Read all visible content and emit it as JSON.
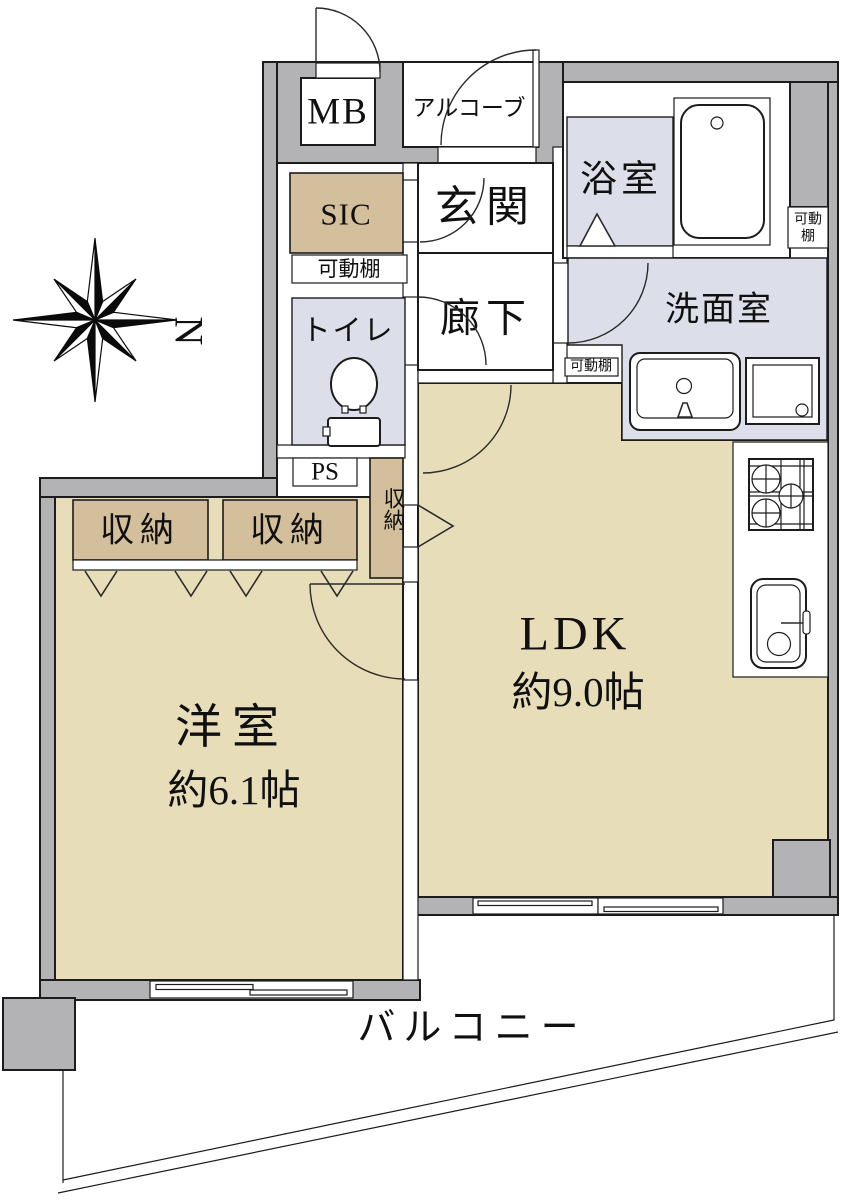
{
  "labels": {
    "mb": "MB",
    "alcove": "アルコーブ",
    "sic": "SIC",
    "entrance": "玄関",
    "hallway": "廊下",
    "bathroom": "浴室",
    "washroom": "洗面室",
    "toilet": "トイレ",
    "ps": "PS",
    "movable_shelf": "可動棚",
    "movable_shelf_line1": "可動",
    "movable_shelf_line2": "棚",
    "closet_left": "収納",
    "closet_right": "収納",
    "closet_column": "収納",
    "western_room_name": "洋室",
    "western_room_size": "約6.1帖",
    "ldk_name": "LDK",
    "ldk_size": "約9.0帖",
    "balcony": "バルコニー",
    "compass_north": "N"
  },
  "colors": {
    "wall_gray": "#b3b2b4",
    "floor_tan": "#e7ddb8",
    "closet_tan": "#d3bf9c",
    "wet_blue": "#dcdfe9",
    "line": "#1c1c1c"
  }
}
